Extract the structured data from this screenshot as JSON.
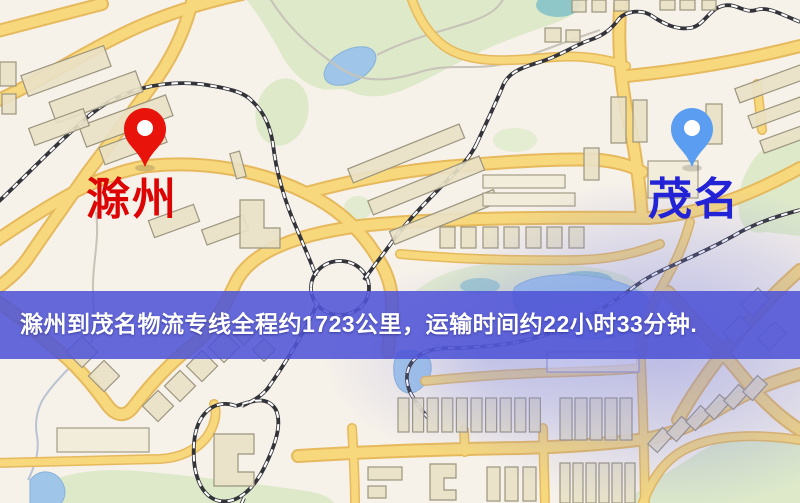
{
  "banner": {
    "text": "滁州到茂名物流专线全程约1723公里，运输时间约22小时33分钟.",
    "background_color": "#5054d6",
    "text_color": "#ffffff",
    "route": {
      "origin": "滁州",
      "destination": "茂名",
      "distance": "约1723公里",
      "duration": "约22小时33分钟"
    }
  },
  "map": {
    "origin_marker": {
      "label": "滁州",
      "pin_color": "#e8140c",
      "pin_edge": "#c40b06",
      "label_color": "#dd0404"
    },
    "destination_marker": {
      "label": "茂名",
      "pin_color": "#5b9df0",
      "pin_edge": "#447fd6",
      "label_color": "#2222d6"
    }
  }
}
